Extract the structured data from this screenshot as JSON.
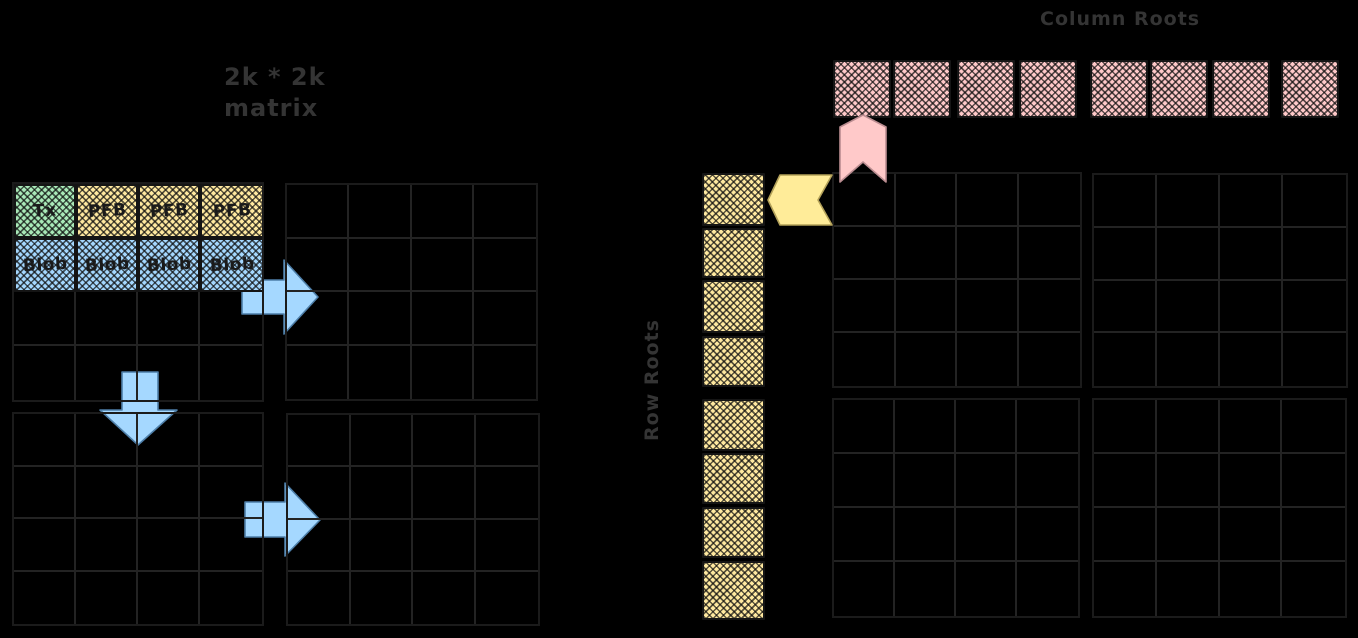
{
  "diagram": {
    "title_lines": [
      "2k * 2k",
      "matrix"
    ],
    "column_roots_label": "Column Roots",
    "row_roots_label": "Row Roots"
  },
  "left_matrix": {
    "grid_rows": 4,
    "grid_cols": 4,
    "quadrants": [
      "top-left",
      "top-right",
      "bottom-left",
      "bottom-right"
    ],
    "data_cells": [
      {
        "label": "Tx",
        "type": "tx",
        "row": 0,
        "col": 0
      },
      {
        "label": "PFB",
        "type": "pfb",
        "row": 0,
        "col": 1
      },
      {
        "label": "PFB",
        "type": "pfb",
        "row": 0,
        "col": 2
      },
      {
        "label": "PFB",
        "type": "pfb",
        "row": 0,
        "col": 3
      },
      {
        "label": "Blob",
        "type": "blob",
        "row": 1,
        "col": 0
      },
      {
        "label": "Blob",
        "type": "blob",
        "row": 1,
        "col": 1
      },
      {
        "label": "Blob",
        "type": "blob",
        "row": 1,
        "col": 2
      },
      {
        "label": "Blob",
        "type": "blob",
        "row": 1,
        "col": 3
      }
    ]
  },
  "right_matrix": {
    "grid_rows": 4,
    "grid_cols": 4,
    "quadrants": [
      "top-left",
      "top-right",
      "bottom-left",
      "bottom-right"
    ]
  },
  "column_roots": {
    "count": 8,
    "group_sizes": [
      4,
      4
    ]
  },
  "row_roots": {
    "count": 8,
    "group_sizes": [
      4,
      4
    ]
  },
  "arrows": [
    {
      "name": "extend-right-top",
      "direction": "right",
      "color_key": "arrow_blue"
    },
    {
      "name": "extend-down",
      "direction": "down",
      "color_key": "arrow_blue"
    },
    {
      "name": "extend-right-bottom",
      "direction": "right",
      "color_key": "arrow_blue"
    },
    {
      "name": "column-root-pointer",
      "direction": "up",
      "color_key": "arrow_pink"
    },
    {
      "name": "row-root-pointer",
      "direction": "left",
      "color_key": "arrow_yellow"
    }
  ],
  "colors": {
    "background": "#000000",
    "tx": "#a9e9b8",
    "pfb": "#ffe9a0",
    "blob": "#a5d8ff",
    "column_root": "#ffc9c9",
    "row_root": "#ffe9a0",
    "arrow_blue": "#a5d8ff",
    "arrow_pink": "#ffc9c9",
    "arrow_yellow": "#ffec99",
    "grid_line": "#232323",
    "grid_border": "#1b1b1b",
    "label_text": "#343434",
    "cell_text": "#1a1a1a"
  }
}
